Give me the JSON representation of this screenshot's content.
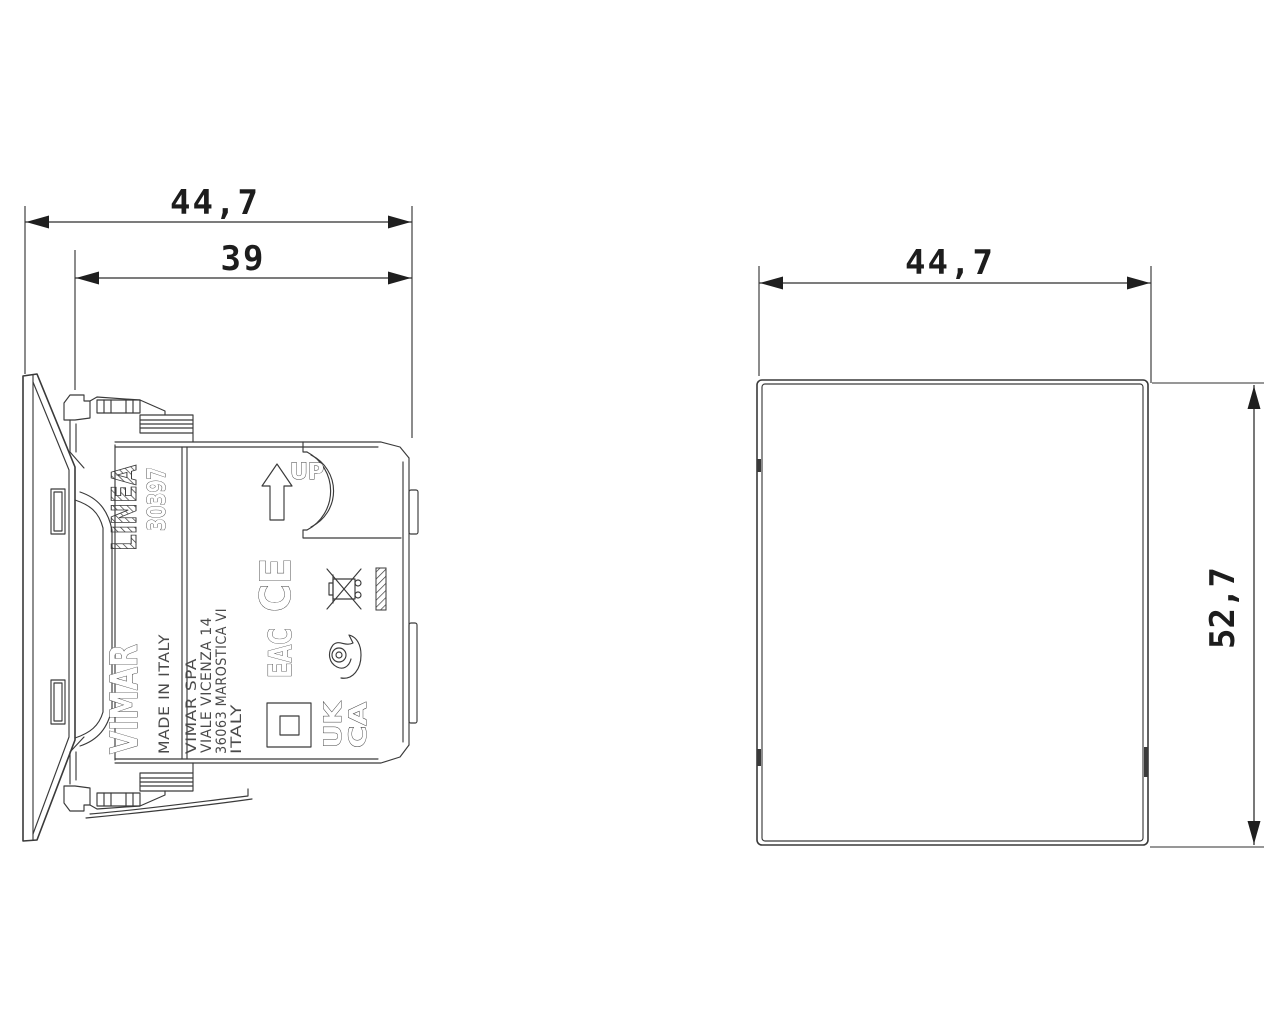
{
  "drawing": {
    "background": "#ffffff",
    "line_color": "#3a3a3a"
  },
  "side_view": {
    "dimensions": {
      "overall_depth": "44,7",
      "mounting_depth": "39"
    },
    "markings": {
      "series": "LINEA",
      "product_code": "30397",
      "brand": "VIMAR",
      "made_in": "MADE IN ITALY",
      "address_line1": "VIMAR  SPA",
      "address_line2": "VIALE  VICENZA  14",
      "address_line3": "36063  MAROSTICA  VI",
      "address_line4": "ITALY",
      "orientation_label": "UP",
      "ce_mark": "CE",
      "eac_mark": "EAC",
      "ukca_line1": "UK",
      "ukca_line2": "CA"
    }
  },
  "front_view": {
    "dimensions": {
      "width": "44,7",
      "height": "52,7"
    }
  }
}
